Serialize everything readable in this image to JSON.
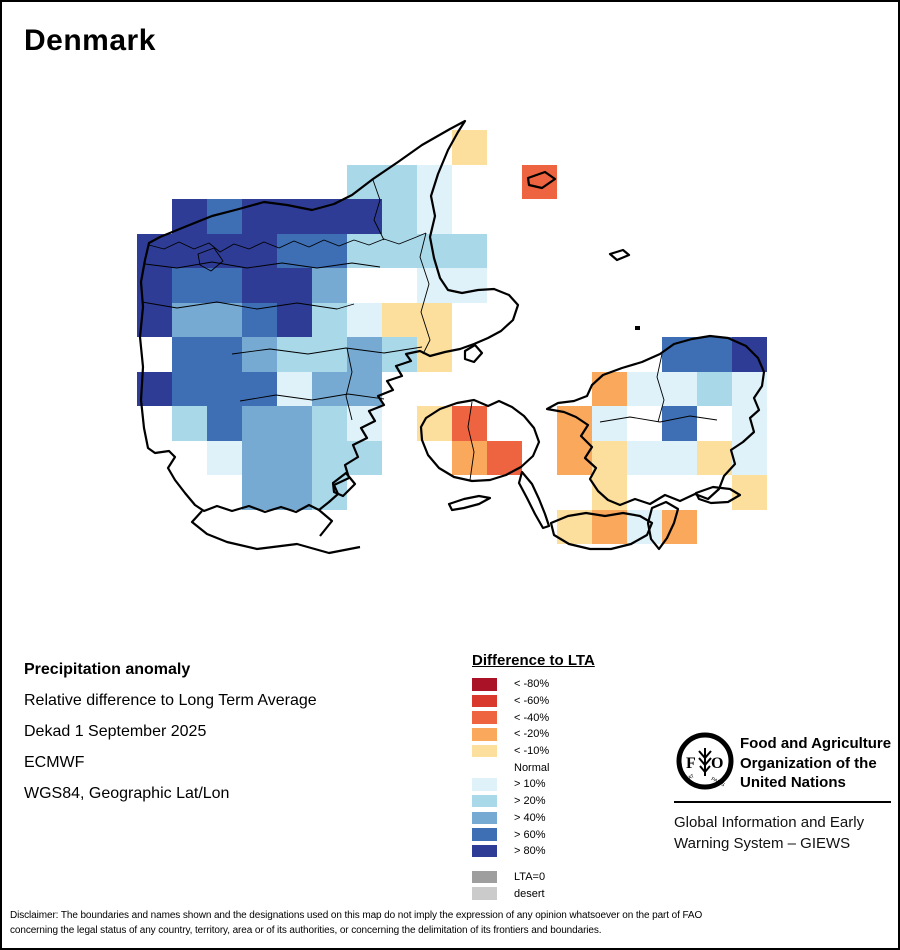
{
  "title": "Denmark",
  "info": {
    "line1": "Precipitation anomaly",
    "line2": "Relative difference to Long Term Average",
    "line3": "Dekad 1 September 2025",
    "line4": "ECMWF",
    "line5": "WGS84, Geographic Lat/Lon"
  },
  "legend": {
    "title": "Difference to LTA",
    "items": [
      {
        "label": "< -80%",
        "color": "#AA1327"
      },
      {
        "label": "< -60%",
        "color": "#D8392C"
      },
      {
        "label": "< -40%",
        "color": "#EE6340"
      },
      {
        "label": "< -20%",
        "color": "#F9A85C"
      },
      {
        "label": "< -10%",
        "color": "#FCDF9C"
      },
      {
        "label": "Normal",
        "color": "#FFFFFF"
      },
      {
        "label": "> 10%",
        "color": "#DFF1F9"
      },
      {
        "label": "> 20%",
        "color": "#A9D8E9"
      },
      {
        "label": "> 40%",
        "color": "#76AAD2"
      },
      {
        "label": "> 60%",
        "color": "#3E6FB5"
      },
      {
        "label": "> 80%",
        "color": "#2E3C95"
      }
    ],
    "extra_items": [
      {
        "label": "LTA=0",
        "color": "#9E9E9E"
      },
      {
        "label": "desert",
        "color": "#CBCBCB"
      }
    ]
  },
  "fao": {
    "logo_letters_left": "F",
    "logo_letters_right": "O",
    "motto_left": "FIAT",
    "motto_right": "PANIS",
    "org_lines": [
      "Food and Agriculture",
      "Organization of the",
      "United Nations"
    ],
    "giews_lines": [
      "Global Information and Early",
      "Warning System – GIEWS"
    ]
  },
  "disclaimer": {
    "line1": "Disclaimer: The boundaries and names shown and the designations used on this map do not imply the expression of any opinion whatsoever on the part of FAO",
    "line2": "concerning the legal status of any country, territory, area or of its authorities, or concerning the delimitation of its frontiers and boundaries."
  },
  "map": {
    "grid": {
      "x0": 135,
      "y0": 128,
      "cell_w": 35,
      "cell_h": 34.5
    },
    "palette": {
      "b80": "#2E3C95",
      "b60": "#3E6FB5",
      "b40": "#76AAD2",
      "b20": "#A9D8E9",
      "b10": "#DFF1F9",
      "y10": "#FCDF9C",
      "o20": "#F9A85C",
      "o40": "#EE6340"
    },
    "cells": [
      [
        9,
        0,
        "y10"
      ],
      [
        6,
        1,
        "b20"
      ],
      [
        7,
        1,
        "b20"
      ],
      [
        8,
        1,
        "b10"
      ],
      [
        11,
        1,
        "o40"
      ],
      [
        1,
        2,
        "b80"
      ],
      [
        2,
        2,
        "b60"
      ],
      [
        3,
        2,
        "b80"
      ],
      [
        4,
        2,
        "b80"
      ],
      [
        5,
        2,
        "b80"
      ],
      [
        6,
        2,
        "b80"
      ],
      [
        7,
        2,
        "b20"
      ],
      [
        8,
        2,
        "b10"
      ],
      [
        0,
        3,
        "b80"
      ],
      [
        1,
        3,
        "b80"
      ],
      [
        2,
        3,
        "b80"
      ],
      [
        3,
        3,
        "b80"
      ],
      [
        4,
        3,
        "b60"
      ],
      [
        5,
        3,
        "b60"
      ],
      [
        6,
        3,
        "b20"
      ],
      [
        7,
        3,
        "b20"
      ],
      [
        8,
        3,
        "b20"
      ],
      [
        9,
        3,
        "b20"
      ],
      [
        0,
        4,
        "b80"
      ],
      [
        1,
        4,
        "b60"
      ],
      [
        2,
        4,
        "b60"
      ],
      [
        3,
        4,
        "b80"
      ],
      [
        4,
        4,
        "b80"
      ],
      [
        5,
        4,
        "b40"
      ],
      [
        8,
        4,
        "b10"
      ],
      [
        9,
        4,
        "b10"
      ],
      [
        0,
        5,
        "b80"
      ],
      [
        1,
        5,
        "b40"
      ],
      [
        2,
        5,
        "b40"
      ],
      [
        3,
        5,
        "b60"
      ],
      [
        4,
        5,
        "b80"
      ],
      [
        5,
        5,
        "b20"
      ],
      [
        6,
        5,
        "b10"
      ],
      [
        7,
        5,
        "y10"
      ],
      [
        8,
        5,
        "y10"
      ],
      [
        1,
        6,
        "b60"
      ],
      [
        2,
        6,
        "b60"
      ],
      [
        3,
        6,
        "b40"
      ],
      [
        4,
        6,
        "b20"
      ],
      [
        5,
        6,
        "b20"
      ],
      [
        6,
        6,
        "b40"
      ],
      [
        7,
        6,
        "b20"
      ],
      [
        8,
        6,
        "y10"
      ],
      [
        15,
        6,
        "b60"
      ],
      [
        16,
        6,
        "b60"
      ],
      [
        17,
        6,
        "b80"
      ],
      [
        0,
        7,
        "b80"
      ],
      [
        1,
        7,
        "b60"
      ],
      [
        2,
        7,
        "b60"
      ],
      [
        3,
        7,
        "b60"
      ],
      [
        4,
        7,
        "b10"
      ],
      [
        5,
        7,
        "b40"
      ],
      [
        6,
        7,
        "b40"
      ],
      [
        13,
        7,
        "o20"
      ],
      [
        14,
        7,
        "b10"
      ],
      [
        15,
        7,
        "b10"
      ],
      [
        16,
        7,
        "b20"
      ],
      [
        17,
        7,
        "b10"
      ],
      [
        1,
        8,
        "b20"
      ],
      [
        2,
        8,
        "b60"
      ],
      [
        3,
        8,
        "b40"
      ],
      [
        4,
        8,
        "b40"
      ],
      [
        5,
        8,
        "b20"
      ],
      [
        6,
        8,
        "b10"
      ],
      [
        8,
        8,
        "y10"
      ],
      [
        9,
        8,
        "o40"
      ],
      [
        12,
        8,
        "o20"
      ],
      [
        13,
        8,
        "b10"
      ],
      [
        15,
        8,
        "b60"
      ],
      [
        17,
        8,
        "b10"
      ],
      [
        2,
        9,
        "b10"
      ],
      [
        3,
        9,
        "b40"
      ],
      [
        4,
        9,
        "b40"
      ],
      [
        5,
        9,
        "b20"
      ],
      [
        6,
        9,
        "b20"
      ],
      [
        9,
        9,
        "o20"
      ],
      [
        10,
        9,
        "o40"
      ],
      [
        12,
        9,
        "o20"
      ],
      [
        13,
        9,
        "y10"
      ],
      [
        14,
        9,
        "b10"
      ],
      [
        15,
        9,
        "b10"
      ],
      [
        16,
        9,
        "y10"
      ],
      [
        17,
        9,
        "b10"
      ],
      [
        3,
        10,
        "b40"
      ],
      [
        4,
        10,
        "b40"
      ],
      [
        5,
        10,
        "b20"
      ],
      [
        13,
        10,
        "y10"
      ],
      [
        17,
        10,
        "y10"
      ],
      [
        12,
        11,
        "y10"
      ],
      [
        13,
        11,
        "o20"
      ],
      [
        14,
        11,
        "b10"
      ],
      [
        15,
        11,
        "o20"
      ]
    ]
  }
}
